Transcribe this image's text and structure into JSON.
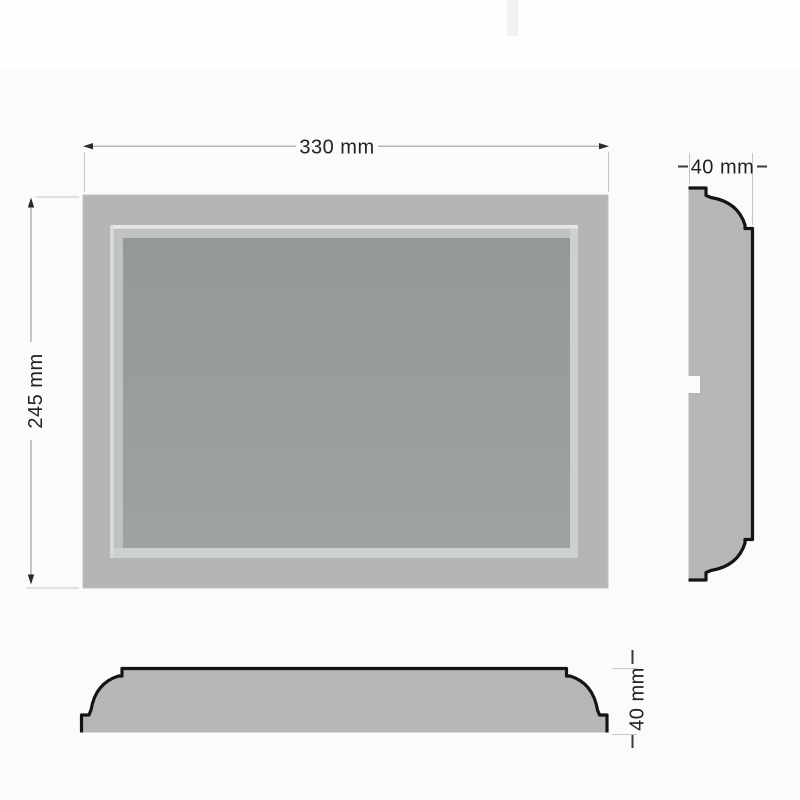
{
  "dimensions": {
    "width": {
      "value": "330 mm"
    },
    "height": {
      "value": "245 mm"
    },
    "depth_side": {
      "value": "40 mm"
    },
    "depth_bottom": {
      "value": "40 mm"
    }
  },
  "colors": {
    "background": "#fafbfb",
    "background_top_band": "#fefefe",
    "scan_artifact": "#f1f2f2",
    "frame_fill": "#b3b6b5",
    "frame_edge": "#bfc2c1",
    "recess_light": "#ccd0cf",
    "lip_highlight_top": "#e6e8e7",
    "lip_highlight_left": "#d8dbda",
    "band": "#bfc2c1",
    "panel_top": "#949997",
    "panel_bottom": "#9ea2a0",
    "profile_fill": "#b5b7b7",
    "outline": "#141414",
    "dim_line": "#9fa1a1",
    "ext_line": "#c6c8c8",
    "stub_line": "#3a3a3a",
    "arrow": "#2a2a2a",
    "dim_text": "#212121"
  }
}
